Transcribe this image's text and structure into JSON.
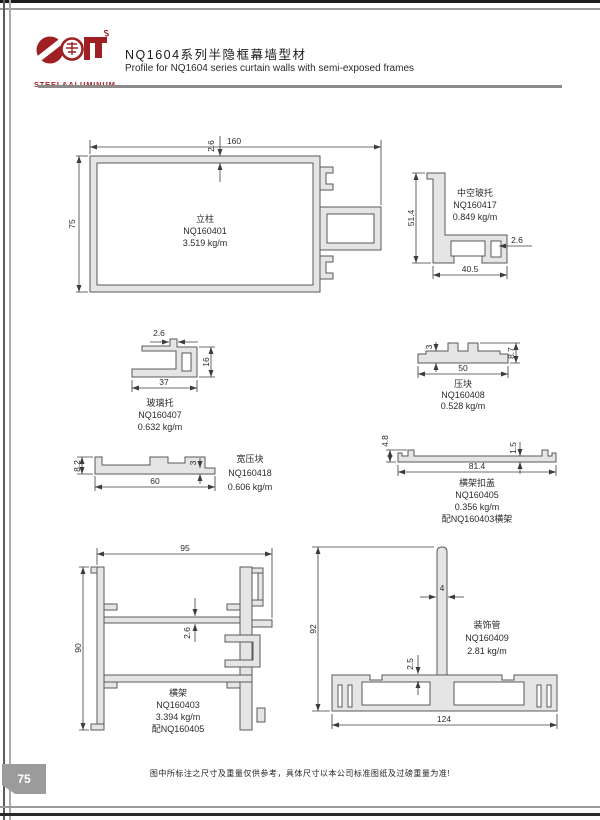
{
  "page": {
    "number": "75",
    "footer_note": "图中所标注之尺寸及重量仅供参考，具体尺寸以本公司标准图纸及过磅重量为准!"
  },
  "header": {
    "logo_text": "STEEL&ALUMINUM",
    "title_cn": "NQ1604系列半隐框幕墙型材",
    "title_en": "Profile for NQ1604 series curtain walls with semi-exposed frames"
  },
  "drawings": {
    "d1": {
      "name": "立柱",
      "code": "NQ160401",
      "weight": "3.519 kg/m",
      "dims": {
        "width": "160",
        "height": "75",
        "wall": "2.6"
      }
    },
    "d2": {
      "name": "中空玻托",
      "code": "NQ160417",
      "weight": "0.849 kg/m",
      "dims": {
        "height": "51.4",
        "width": "40.5",
        "wall": "2.6"
      }
    },
    "d3": {
      "name": "玻璃托",
      "code": "NQ160407",
      "weight": "0.632 kg/m",
      "dims": {
        "wall": "2.6",
        "box": "16",
        "width": "37"
      }
    },
    "d4": {
      "name": "压块",
      "code": "NQ160408",
      "weight": "0.528 kg/m",
      "dims": {
        "thick": "3",
        "height": "8.7",
        "width": "50"
      }
    },
    "d5": {
      "name": "宽压块",
      "code": "NQ160418",
      "weight": "0.606 kg/m",
      "dims": {
        "height": "8.2",
        "thick": "3",
        "width": "60"
      }
    },
    "d6": {
      "name": "横架扣盖",
      "code": "NQ160405",
      "weight": "0.356 kg/m",
      "note": "配NQ160403横架",
      "dims": {
        "height": "4.8",
        "thick": "1.5",
        "width": "81.4"
      }
    },
    "d7": {
      "name": "横架",
      "code": "NQ160403",
      "weight": "3.394 kg/m",
      "note": "配NQ160405",
      "dims": {
        "width": "95",
        "height": "90",
        "wall": "2.6"
      }
    },
    "d8": {
      "name": "装饰管",
      "code": "NQ160409",
      "weight": "2.81 kg/m",
      "dims": {
        "height": "92",
        "fin": "4",
        "wall": "2.5",
        "width": "124"
      }
    }
  },
  "colors": {
    "brand_red": "#9e2023",
    "profile_fill": "#e5e5e5",
    "line": "#3d3d3d"
  }
}
